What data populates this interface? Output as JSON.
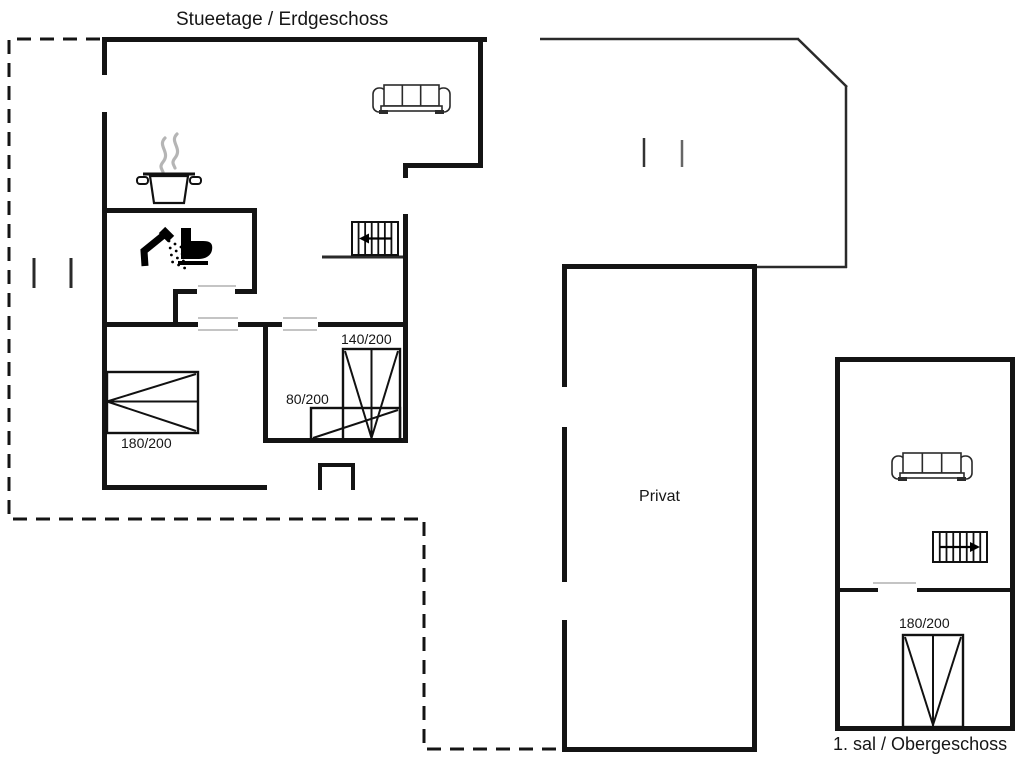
{
  "labels": {
    "floor_ground": "Stueetage / Erdgeschoss",
    "floor_upper": "1. sal / Obergeschoss",
    "room_private": "Privat",
    "bed_double_ground": "180/200",
    "bed_140": "140/200",
    "bed_80": "80/200",
    "bed_double_upper": "180/200"
  },
  "colors": {
    "ink": "#141414",
    "thin": "#2a2a2a",
    "door_marker": "#c4c4c4",
    "steam": "#b5b5b5",
    "furniture_stroke": "#2b2b2b",
    "background": "#ffffff"
  },
  "geometry": {
    "dashed_path": "M 100 39 L 9 39 L 9 519 L 424 519 L 424 749 L 561 749",
    "walls": [
      [
        102,
        37,
        385,
        5
      ],
      [
        102,
        37,
        5,
        38
      ],
      [
        102,
        112,
        5,
        378
      ],
      [
        102,
        485,
        165,
        5
      ],
      [
        263,
        323,
        5,
        120
      ],
      [
        263,
        438,
        145,
        5
      ],
      [
        403,
        214,
        5,
        229
      ],
      [
        403,
        163,
        5,
        15
      ],
      [
        403,
        163,
        80,
        5
      ],
      [
        478,
        37,
        5,
        131
      ],
      [
        102,
        208,
        155,
        5
      ],
      [
        252,
        208,
        5,
        86
      ],
      [
        173,
        289,
        24,
        5
      ],
      [
        235,
        289,
        22,
        5
      ],
      [
        173,
        289,
        5,
        38
      ],
      [
        102,
        322,
        96,
        5
      ],
      [
        238,
        322,
        44,
        5
      ],
      [
        318,
        322,
        90,
        5
      ],
      [
        562,
        264,
        195,
        5
      ],
      [
        752,
        264,
        5,
        488
      ],
      [
        562,
        747,
        195,
        5
      ],
      [
        562,
        264,
        5,
        123
      ],
      [
        562,
        427,
        5,
        155
      ],
      [
        562,
        620,
        5,
        132
      ],
      [
        318,
        463,
        4,
        27
      ],
      [
        318,
        463,
        37,
        4
      ],
      [
        351,
        463,
        4,
        27
      ],
      [
        835,
        357,
        180,
        5
      ],
      [
        835,
        357,
        5,
        374
      ],
      [
        1010,
        357,
        5,
        374
      ],
      [
        835,
        726,
        180,
        5
      ],
      [
        835,
        588,
        43,
        4
      ],
      [
        917,
        588,
        98,
        4
      ]
    ],
    "thin_lines": [
      [
        540,
        39,
        799,
        39,
        2.5
      ],
      [
        798,
        39,
        847,
        87,
        2.5
      ],
      [
        846,
        86,
        846,
        268,
        2.5
      ],
      [
        757,
        267,
        847,
        267,
        2.5
      ],
      [
        322,
        257,
        406,
        257,
        3
      ],
      [
        34,
        258,
        34,
        288,
        3
      ],
      [
        71,
        258,
        71,
        288,
        3
      ],
      [
        644,
        138,
        644,
        167,
        2.5,
        "#333333"
      ],
      [
        682,
        140,
        682,
        167,
        2.5,
        "#666666"
      ]
    ],
    "door_markers": [
      [
        198,
        286,
        236,
        286
      ],
      [
        198,
        318,
        238,
        318
      ],
      [
        198,
        330,
        238,
        330
      ],
      [
        283,
        318,
        317,
        318
      ],
      [
        283,
        330,
        317,
        330
      ],
      [
        873,
        583,
        916,
        583
      ]
    ],
    "furniture": [
      {
        "type": "sofa",
        "x": 373,
        "y": 85,
        "w": 77,
        "h": 30,
        "name": "sofa-living-room"
      },
      {
        "type": "sofa",
        "x": 892,
        "y": 453,
        "w": 80,
        "h": 29,
        "name": "sofa-upper-floor"
      },
      {
        "type": "pot",
        "x": 145,
        "y": 170,
        "w": 48,
        "h": 33,
        "name": "stove-pot-icon"
      },
      {
        "type": "shower",
        "x": 138,
        "y": 228,
        "name": "shower-icon"
      },
      {
        "type": "toilet",
        "x": 177,
        "y": 228,
        "name": "toilet-icon"
      },
      {
        "type": "stairs",
        "x": 352,
        "y": 222,
        "w": 46,
        "h": 33,
        "bars": 6,
        "dir": "left",
        "name": "stairs-ground"
      },
      {
        "type": "stairs",
        "x": 933,
        "y": 532,
        "w": 54,
        "h": 30,
        "bars": 7,
        "dir": "right",
        "name": "stairs-upper"
      },
      {
        "type": "bed",
        "variant": "side",
        "x": 107,
        "y": 372,
        "w": 91,
        "h": 61,
        "name": "bed-180x200-ground"
      },
      {
        "type": "bed",
        "variant": "vfoot",
        "x": 343,
        "y": 349,
        "w": 57,
        "h": 91,
        "name": "bed-140x200"
      },
      {
        "type": "bed",
        "variant": "diag",
        "x": 311,
        "y": 408,
        "w": 89,
        "h": 32,
        "name": "bed-80x200"
      },
      {
        "type": "bed",
        "variant": "vfoot",
        "x": 903,
        "y": 635,
        "w": 60,
        "h": 92,
        "name": "bed-180x200-upper"
      }
    ]
  }
}
